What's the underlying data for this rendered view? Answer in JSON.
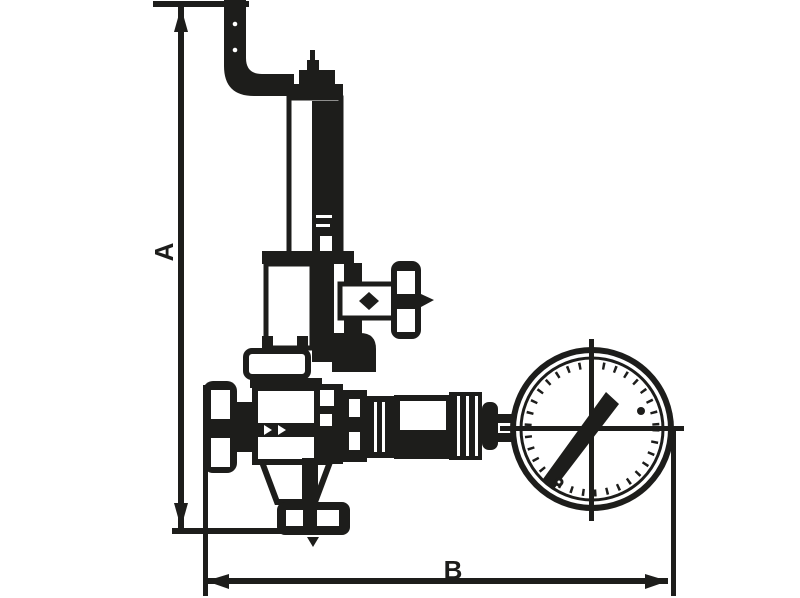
{
  "diagram": {
    "type": "technical dimension drawing",
    "subject": "safety relief valve with lifting lever, test handwheel, inlet handwheel and pressure gauge",
    "labels": {
      "height_dimension": "A",
      "width_dimension": "B"
    },
    "colors": {
      "ink": "#1d1d1b",
      "background": "#ffffff"
    },
    "parts": [
      "lifting-lever-pipe",
      "spring-housing-column",
      "bonnet",
      "test-handwheel",
      "inlet-handwheel",
      "valve-body",
      "drain-funnel",
      "bottom-outlet-flange",
      "gauge-connection-pipe",
      "pressure-gauge-dial",
      "gauge-needle"
    ]
  }
}
